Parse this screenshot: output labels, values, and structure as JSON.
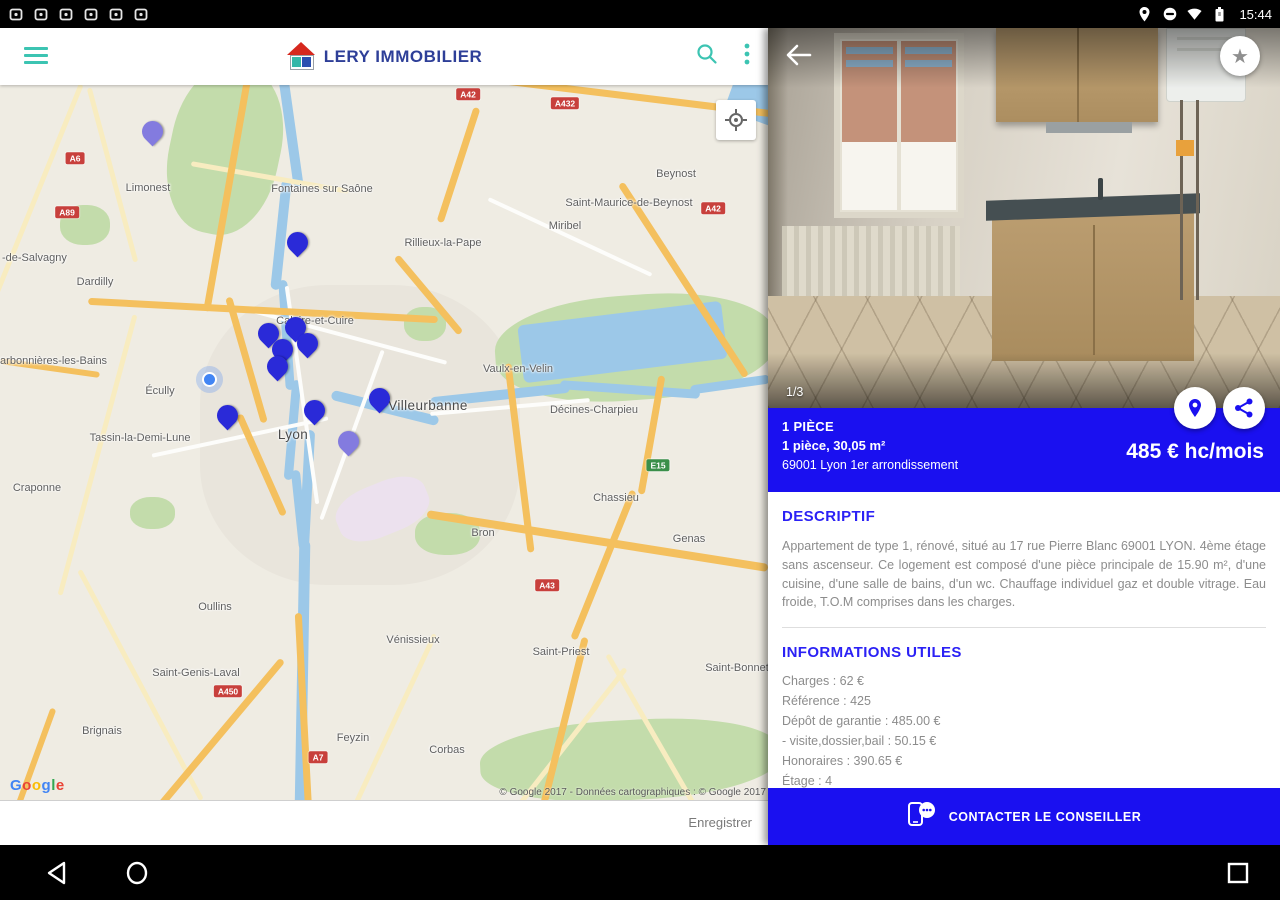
{
  "status_bar": {
    "time": "15:44",
    "left_icons": [
      "alarm-icon",
      "screenshot-icon",
      "gallery-icon",
      "device-icon",
      "calendar-icon",
      "app-notification-icon"
    ],
    "right_icons": [
      "location-icon",
      "dnd-icon",
      "wifi-icon",
      "battery-icon"
    ]
  },
  "toolbar": {
    "brand": "LERY IMMOBILIER"
  },
  "map": {
    "attribution": "© Google 2017 - Données cartographiques : © Google 2017",
    "google_logo": {
      "text": "Google",
      "letter_colors": [
        "#4285F4",
        "#EA4335",
        "#FBBC05",
        "#4285F4",
        "#34A853",
        "#EA4335"
      ]
    },
    "save_label": "Enregistrer",
    "labels": [
      {
        "t": "Limonest",
        "x": 148,
        "y": 97
      },
      {
        "t": "Fontaines sur Saône",
        "x": 322,
        "y": 98
      },
      {
        "t": "Beynost",
        "x": 676,
        "y": 83
      },
      {
        "t": "Saint-Maurice-de-Beynost",
        "x": 629,
        "y": 112
      },
      {
        "t": "Miribel",
        "x": 565,
        "y": 135
      },
      {
        "t": "Rillieux-la-Pape",
        "x": 443,
        "y": 152
      },
      {
        "t": "-de-Salvagny",
        "x": 2,
        "y": 167,
        "a": "l"
      },
      {
        "t": "Dardilly",
        "x": 95,
        "y": 191
      },
      {
        "t": "Caluire-et-Cuire",
        "x": 315,
        "y": 230
      },
      {
        "t": "Charbonnières-les-Bains",
        "x": -14,
        "y": 270,
        "a": "l"
      },
      {
        "t": "Écully",
        "x": 160,
        "y": 300
      },
      {
        "t": "Vaulx-en-Velin",
        "x": 518,
        "y": 278
      },
      {
        "t": "Villeurbanne",
        "x": 428,
        "y": 313,
        "s": 2
      },
      {
        "t": "Décines-Charpieu",
        "x": 594,
        "y": 319
      },
      {
        "t": "Tassin-la-Demi-Lune",
        "x": 140,
        "y": 347
      },
      {
        "t": "Lyon",
        "x": 293,
        "y": 342,
        "s": 2
      },
      {
        "t": "Craponne",
        "x": 37,
        "y": 397
      },
      {
        "t": "Chassieu",
        "x": 616,
        "y": 407
      },
      {
        "t": "Bron",
        "x": 483,
        "y": 442
      },
      {
        "t": "Genas",
        "x": 689,
        "y": 448
      },
      {
        "t": "Oullins",
        "x": 215,
        "y": 516
      },
      {
        "t": "Vénissieux",
        "x": 413,
        "y": 549
      },
      {
        "t": "Saint-Priest",
        "x": 561,
        "y": 561
      },
      {
        "t": "Saint-Genis-Laval",
        "x": 196,
        "y": 582
      },
      {
        "t": "Saint-Bonnet",
        "x": 737,
        "y": 577
      },
      {
        "t": "Feyzin",
        "x": 353,
        "y": 647
      },
      {
        "t": "Corbas",
        "x": 447,
        "y": 659
      },
      {
        "t": "Brignais",
        "x": 102,
        "y": 640
      }
    ],
    "badges": [
      {
        "t": "A6",
        "x": 75,
        "y": 73
      },
      {
        "t": "A89",
        "x": 67,
        "y": 127
      },
      {
        "t": "A42",
        "x": 468,
        "y": 9
      },
      {
        "t": "A432",
        "x": 565,
        "y": 18
      },
      {
        "t": "A42",
        "x": 713,
        "y": 123
      },
      {
        "t": "E15",
        "x": 658,
        "y": 380,
        "c": "green"
      },
      {
        "t": "A43",
        "x": 547,
        "y": 500
      },
      {
        "t": "A450",
        "x": 228,
        "y": 606
      },
      {
        "t": "A7",
        "x": 318,
        "y": 672
      }
    ],
    "pins": [
      {
        "x": 152,
        "y": 63,
        "c": "purple"
      },
      {
        "x": 297,
        "y": 174,
        "c": "blue"
      },
      {
        "x": 268,
        "y": 265,
        "c": "blue"
      },
      {
        "x": 295,
        "y": 259,
        "c": "blue"
      },
      {
        "x": 307,
        "y": 275,
        "c": "blue"
      },
      {
        "x": 282,
        "y": 281,
        "c": "blue"
      },
      {
        "x": 277,
        "y": 298,
        "c": "blue"
      },
      {
        "x": 227,
        "y": 347,
        "c": "blue"
      },
      {
        "x": 314,
        "y": 342,
        "c": "blue"
      },
      {
        "x": 379,
        "y": 330,
        "c": "blue"
      },
      {
        "x": 348,
        "y": 373,
        "c": "purple"
      }
    ],
    "location_dot": {
      "x": 208,
      "y": 293
    }
  },
  "property": {
    "photo_index": "1/3",
    "type": "1 PIÈCE",
    "summary": "1 pièce, 30,05 m²",
    "address": "69001 Lyon 1er arrondissement",
    "price": "485 € hc/mois",
    "descriptif": {
      "title": "DESCRIPTIF",
      "body": "Appartement de type 1, rénové, situé au 17 rue Pierre Blanc 69001 LYON. 4ème étage sans ascenseur. Ce logement est composé d'une pièce principale de 15.90 m², d'une cuisine, d'une salle de bains, d'un wc. Chauffage individuel gaz et double vitrage. Eau froide, T.O.M comprises dans les charges."
    },
    "infos": {
      "title": "INFORMATIONS UTILES",
      "items": [
        "Charges : 62 €",
        "Référence : 425",
        "Dépôt de garantie : 485.00 €",
        "- visite,dossier,bail : 50.15 €",
        "Honoraires : 390.65 €",
        "Étage : 4",
        "Mode de chauffage : Gaz"
      ]
    },
    "contact_button": "CONTACTER LE CONSEILLER"
  },
  "colors": {
    "accent_blue": "#1a10f0",
    "teal": "#3cc4b2",
    "brand_navy": "#2e3f98",
    "pin_blue": "#2a2ad8",
    "pin_purple": "#837bdf"
  }
}
